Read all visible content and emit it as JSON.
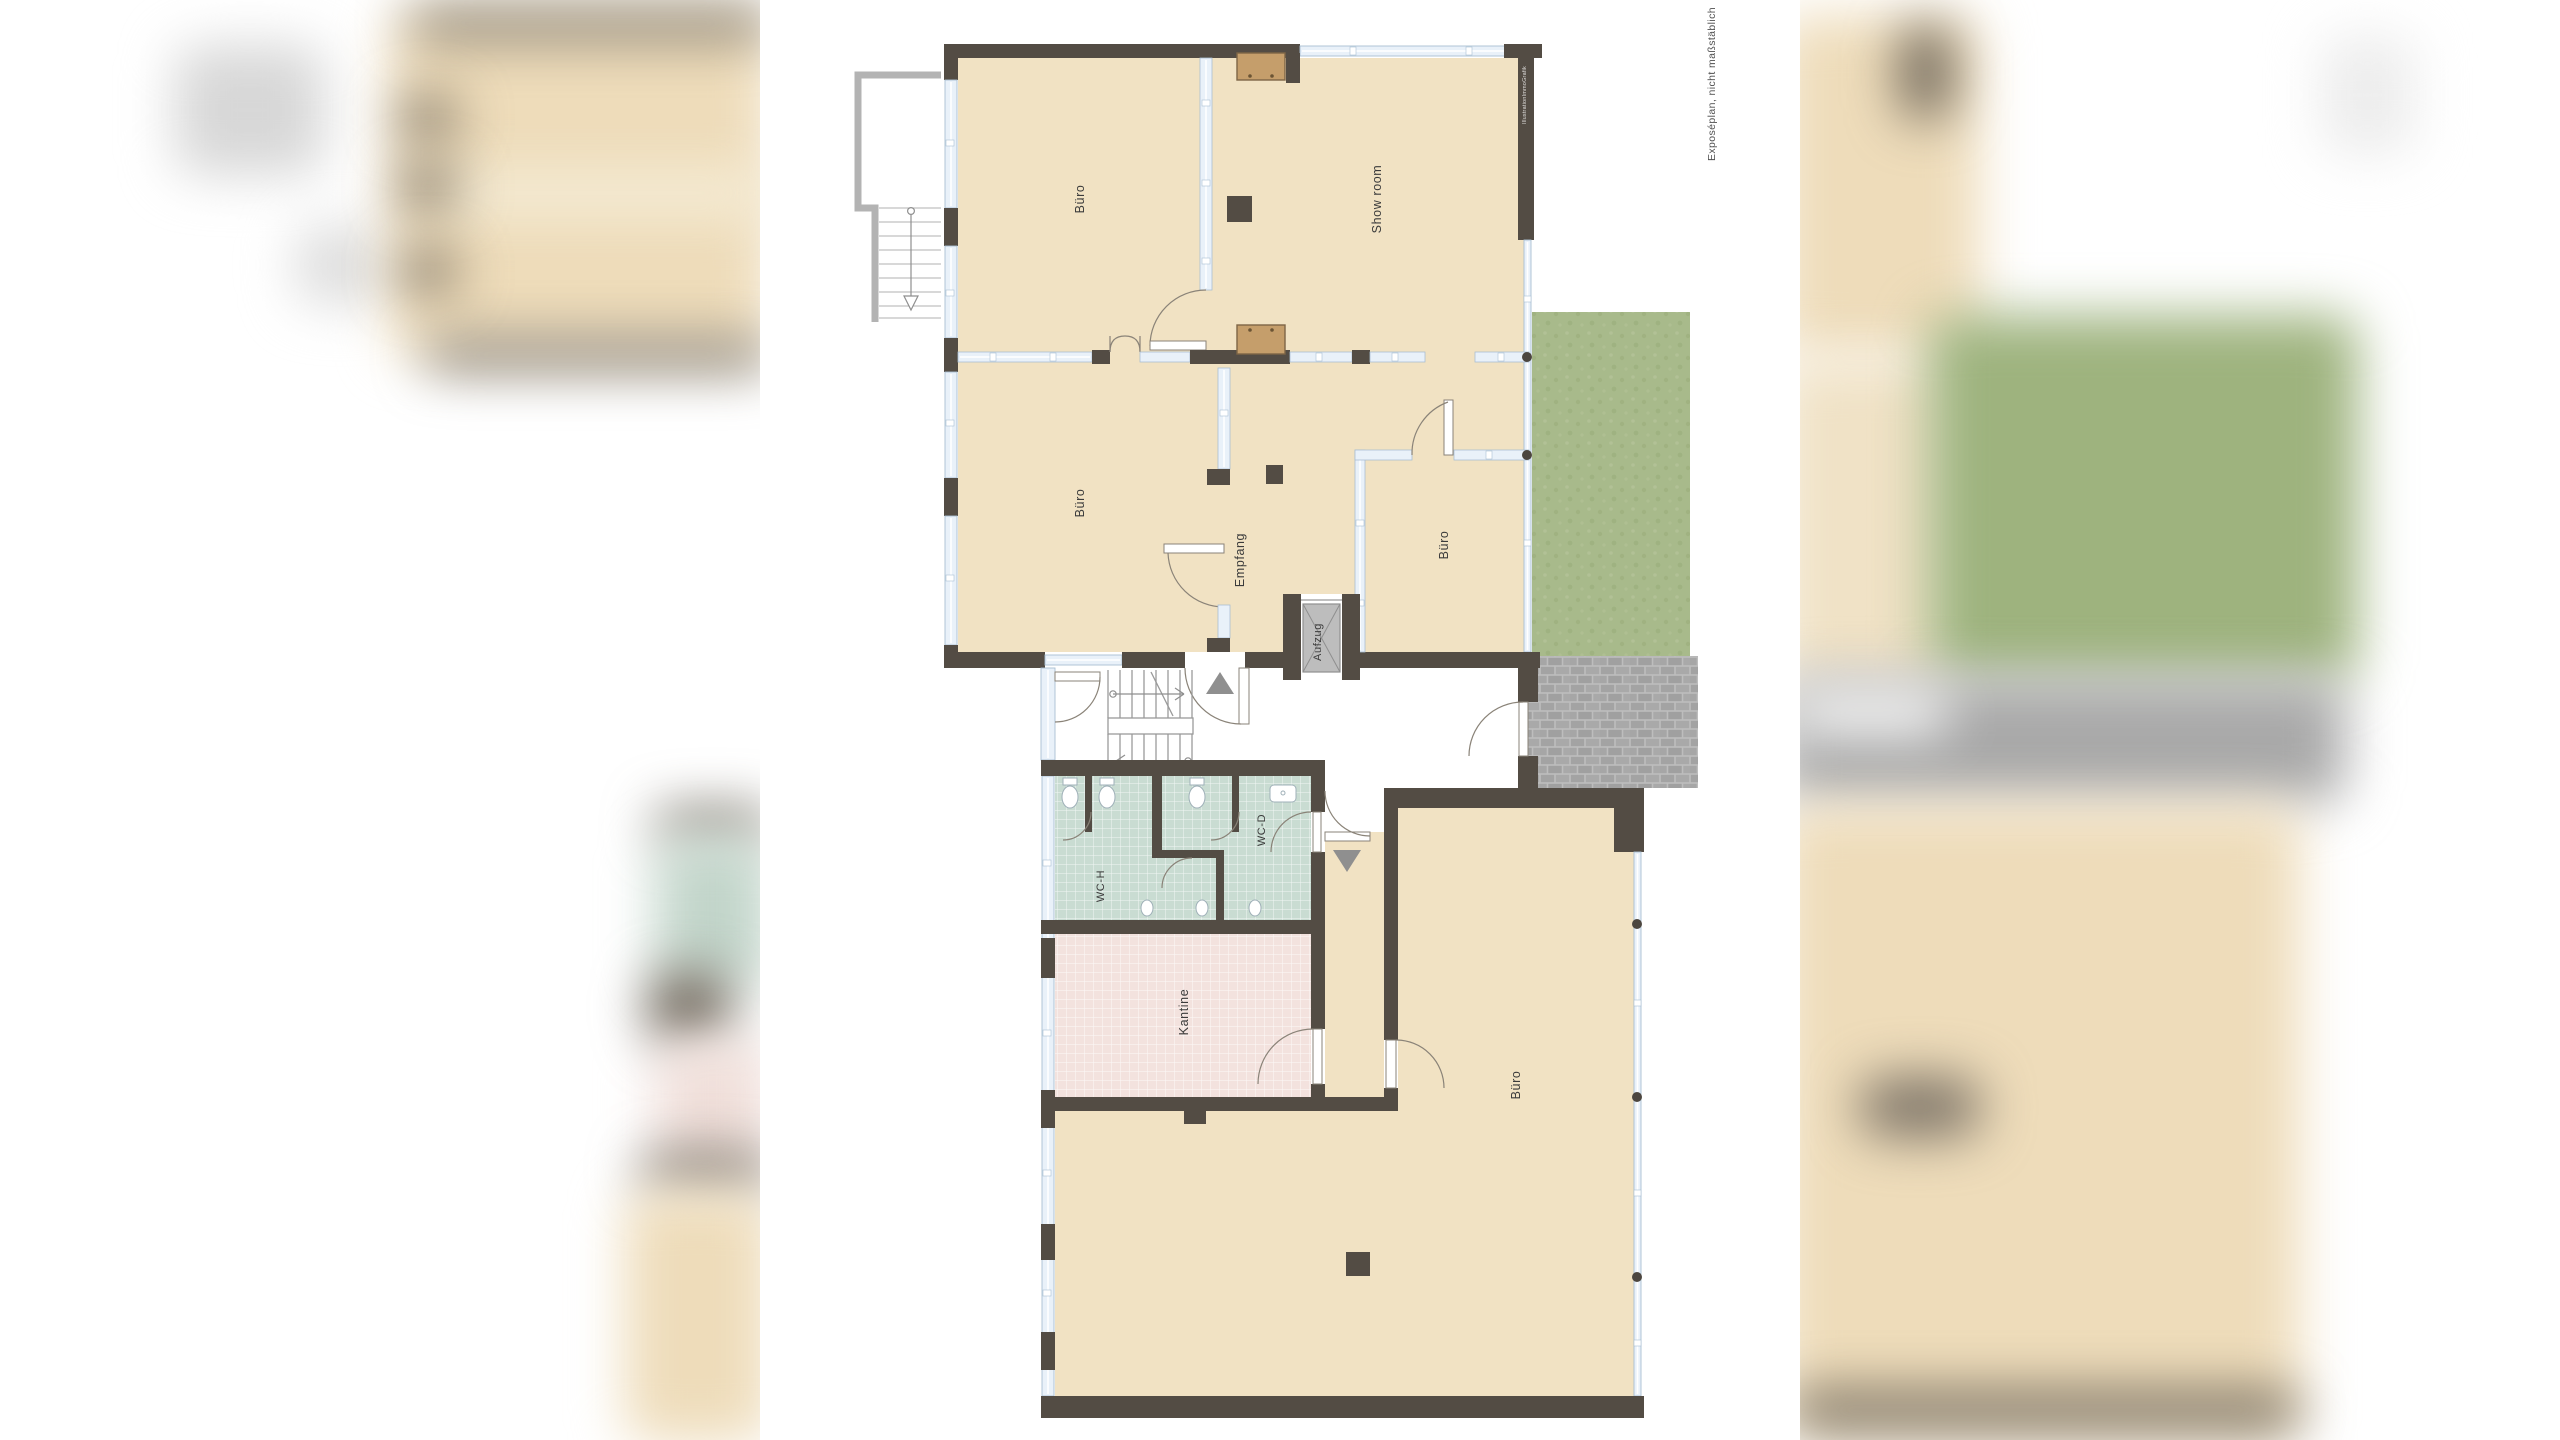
{
  "document": {
    "kind": "real-estate exposé floor plan",
    "layout": "white plan page centered between blurred plan-preview side bands"
  },
  "labels": {
    "buero_top": "Büro",
    "showroom": "Show room",
    "buero_mid": "Büro",
    "empfang": "Empfang",
    "buero_right": "Büro",
    "aufzug": "Aufzug",
    "wc_h": "WC-H",
    "wc_d": "WC-D",
    "kantine": "Kantine",
    "buero_lower": "Büro",
    "disclaimer": "Exposéplan, nicht maßstäblich",
    "watermark": "IllustrationImmoGrafik"
  },
  "floors": {
    "upper_section": {
      "rooms": [
        {
          "id": "buero_top",
          "label": "Büro"
        },
        {
          "id": "showroom",
          "label": "Show room"
        },
        {
          "id": "buero_mid",
          "label": "Büro"
        },
        {
          "id": "empfang",
          "label": "Empfang"
        },
        {
          "id": "buero_right",
          "label": "Büro"
        },
        {
          "id": "aufzug",
          "label": "Aufzug"
        }
      ],
      "features": [
        "external staircase with railing",
        "elevator shaft with cabin cross",
        "glazed partitions",
        "garden area",
        "paved terrace"
      ]
    },
    "lower_section": {
      "rooms": [
        {
          "id": "wc_h",
          "label": "WC-H",
          "floor_finish": "green tiles"
        },
        {
          "id": "wc_d",
          "label": "WC-D",
          "floor_finish": "green tiles"
        },
        {
          "id": "kantine",
          "label": "Kantine",
          "floor_finish": "pink tiles"
        },
        {
          "id": "buero_lower",
          "label": "Büro",
          "floor_finish": "beige"
        }
      ],
      "features": [
        "U-staircase with landing and direction arrows",
        "entrance arrows",
        "glass curtain facade with mullion dots"
      ]
    }
  },
  "colors": {
    "wall": "#534c44",
    "floor": "#f1e2c3",
    "window_fill": "#e9f1f9",
    "window_stroke": "#a9bfd2",
    "garden": "#a8ba8b",
    "terrace": "#a6a6a6",
    "tile_wc": "#c9dcd2",
    "tile_kantine": "#f3e2de",
    "railing": "#b3b3b3",
    "elevator": "#bdbdbd",
    "furniture": "#c59e6b",
    "label": "#3b3b3b",
    "arrow_gray": "#8f8f8f"
  }
}
